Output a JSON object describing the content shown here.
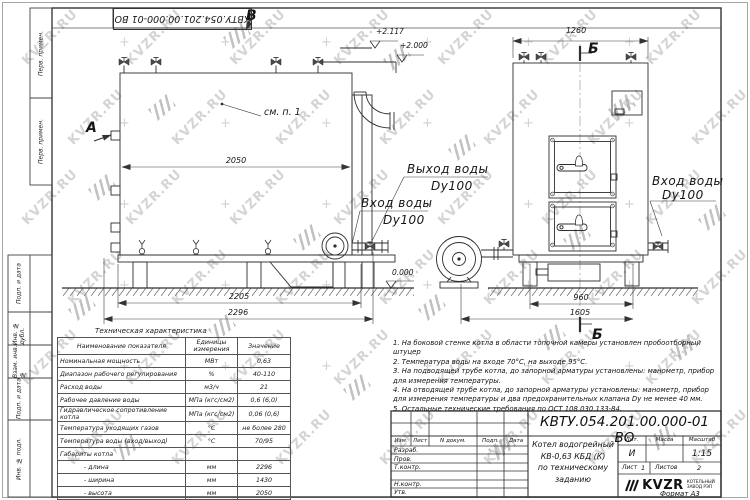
{
  "watermark": {
    "text": "KVZR.RU"
  },
  "left_margin": {
    "boxes": [
      "Перв. примен.",
      "Перв. примен.",
      "Подп. и дата",
      "Инв. № дубл.",
      "Взам. инв. №",
      "Подп. и дата",
      "Инв. № подл."
    ]
  },
  "drawing": {
    "view_letter_b": "В",
    "view_letter_a": "А",
    "section_letter_b": "Б",
    "see_note": "см. п. 1",
    "elevations": {
      "top": "+2.117",
      "middle": "+2.000",
      "zero": "0.000"
    },
    "dimensions": {
      "width_2050": "2050",
      "base_2205": "2205",
      "length_2296": "2296",
      "front_1260": "1260",
      "base_960": "960",
      "front_1605": "1605"
    },
    "labels": {
      "water_outlet": "Выход воды",
      "water_outlet_dn": "Dy100",
      "water_inlet": "Вход воды",
      "water_inlet_dn": "Dy100"
    }
  },
  "tech_table": {
    "title": "Техническая характеристика",
    "headers": [
      "Наименование показателя",
      "Единицы измерения",
      "Значение"
    ],
    "rows": [
      [
        "Номинальная мощность",
        "МВт",
        "0,63"
      ],
      [
        "Диапазон рабочего регулирования",
        "%",
        "40-110"
      ],
      [
        "Расход воды",
        "м3/ч",
        "21"
      ],
      [
        "Рабочее давление воды",
        "МПа (кгс/см2)",
        "0,6 (6,0)"
      ],
      [
        "Гидравлическое сопротивление котла",
        "МПа (кгс/см2)",
        "0,06 (0,6)"
      ],
      [
        "Температура уходящих газов",
        "°С",
        "не более 280"
      ],
      [
        "Температура воды (вход/выход)",
        "°С",
        "70/95"
      ],
      [
        "Габариты котла",
        "",
        ""
      ],
      [
        "- длина",
        "мм",
        "2296"
      ],
      [
        "- ширина",
        "мм",
        "1430"
      ],
      [
        "- высота",
        "мм",
        "2050"
      ]
    ]
  },
  "notes": [
    "1.  На боковой стенке котла в области топочной камеры установлен пробоотборный штуцер",
    "2.  Температура воды на входе 70°С, на выходе 95°С.",
    "3.  На подводящей трубе котла, до запорной арматуры установлены: манометр, прибор для измерения температуры.",
    "4.  На отводящей трубе котла, до запорной арматуры установлены: манометр, прибор для измерения температуры и два предохранительных клапана Dу не менее 40 мм.",
    "5.  Остальные технические требования по ОСТ 108.030.133-84."
  ],
  "title_block": {
    "designation": "КВТУ.054.201.00.000-01 ВО",
    "product_name": [
      "Котел водогрейный",
      "КВ-0,63 КБД (К)",
      "по техническому заданию"
    ],
    "columns": [
      "Изм.",
      "Лист",
      "N докум.",
      "Подп.",
      "Дата"
    ],
    "signature_rows": [
      "Разраб.",
      "Пров.",
      "Т.контр.",
      "Н.контр.",
      "Утв."
    ],
    "lit_label": "Лит.",
    "mass_label": "Масса",
    "scale_label": "Масштаб",
    "lit_value": "И",
    "scale_value": "1:15",
    "sheet_label": "Лист",
    "sheet_value": "1",
    "sheets_label": "Листов",
    "sheets_value": "2",
    "company": {
      "logo_text": "KVZR",
      "name_line1": "КОТЕЛЬНЫЙ",
      "name_line2": "ЗАВОД РЭП"
    },
    "format_note": "Формат  А3"
  }
}
